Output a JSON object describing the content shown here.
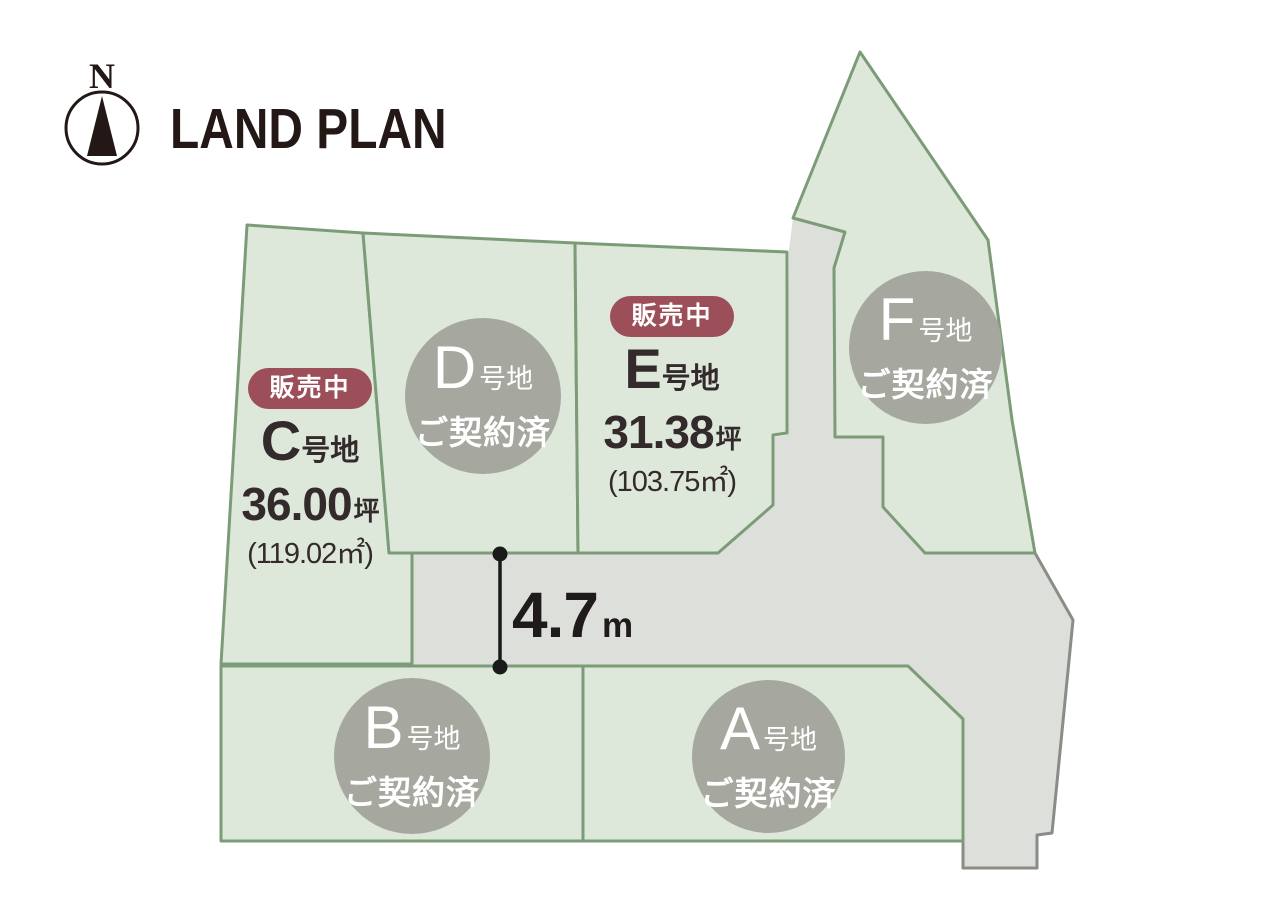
{
  "header": {
    "title": "LAND PLAN",
    "compass": {
      "label": "N"
    }
  },
  "colors": {
    "lot_fill": "#dde8db",
    "lot_border": "#7c9c78",
    "road_fill": "#dcdfda",
    "road_outer_border": "#898c87",
    "sold_circle_fill": "#a6a8a0",
    "badge_fill": "#9c4f58",
    "badge_text": "#ffffff",
    "text_dark": "#332a2b",
    "title_color": "#231815",
    "dimension_line": "#1a1a1a"
  },
  "lots": {
    "c": {
      "status_badge": "販売中",
      "letter": "C",
      "suffix": "号地",
      "area_tsubo": "36.00",
      "tsubo_unit": "坪",
      "area_sqm": "(119.02㎡)"
    },
    "d": {
      "letter": "D",
      "suffix": "号地",
      "status": "ご契約済"
    },
    "e": {
      "status_badge": "販売中",
      "letter": "E",
      "suffix": "号地",
      "area_tsubo": "31.38",
      "tsubo_unit": "坪",
      "area_sqm": "(103.75㎡)"
    },
    "f": {
      "letter": "F",
      "suffix": "号地",
      "status": "ご契約済"
    },
    "b": {
      "letter": "B",
      "suffix": "号地",
      "status": "ご契約済"
    },
    "a": {
      "letter": "A",
      "suffix": "号地",
      "status": "ご契約済"
    }
  },
  "dimension": {
    "value": "4.7",
    "unit": "m"
  }
}
